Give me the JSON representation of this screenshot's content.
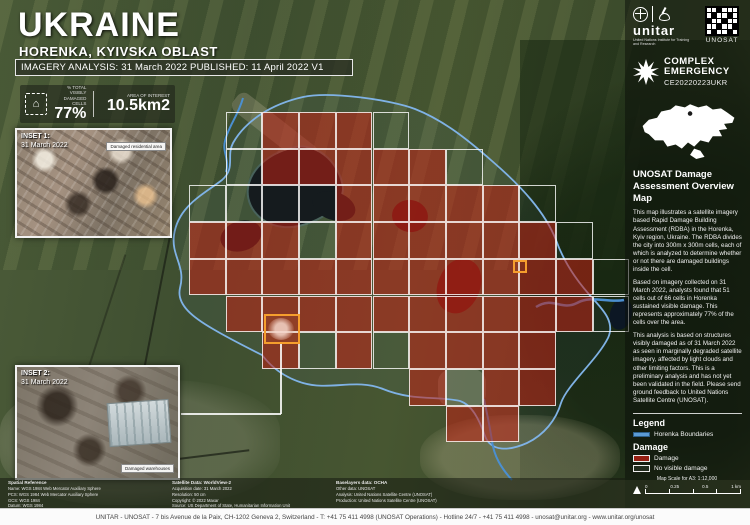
{
  "header": {
    "title": "UKRAINE",
    "subtitle": "HORENKA, KYIVSKA OBLAST",
    "banner": "IMAGERY ANALYSIS: 31 March 2022 PUBLISHED: 11 April 2022 V1"
  },
  "stats": {
    "damaged_icon": "damaged-building-icon",
    "damaged_glyph": "⌂",
    "damaged_label": "% TOTAL VISIBLY DAMAGED CELLS",
    "damaged_value": "77%",
    "area_label": "AREA OF INTEREST",
    "area_value": "10.5km2"
  },
  "insets": [
    {
      "name": "INSET 1:",
      "date": "31 March 2022",
      "callout": "Damaged residential area"
    },
    {
      "name": "INSET 2:",
      "date": "31 March 2022",
      "callout": "Damaged warehouses"
    }
  ],
  "sidebar": {
    "unitar_label": "unitar",
    "unitar_caption": "United Nations Institute for Training and Research",
    "unosat_label": "UNOSAT",
    "emergency_line1": "COMPLEX",
    "emergency_line2": "EMERGENCY",
    "emergency_code": "CE20220223UKR",
    "overview_title": "UNOSAT Damage Assessment Overview Map",
    "paragraphs": [
      "This map illustrates a satellite imagery based Rapid Damage Building Assessment (RDBA) in the Horenka, Kyiv region, Ukraine. The RDBA divides the city into 300m x 300m cells, each of which is analyzed to determine whether or not there are damaged buildings inside the cell.",
      "Based on imagery collected on 31 March 2022, analysts found that 51 cells out of 66 cells in Horenka sustained visible damage. This represents approximately 77% of the cells over the area.",
      "This analysis is based on structures visibly damaged as of 31 March 2022 as seen in marginally degraded satellite imagery, affected by light clouds and other limiting factors. This is a preliminary analysis and has not yet been validated in the field. Please send ground feedback to United Nations Satellite Centre (UNOSAT)."
    ],
    "legend": {
      "title": "Legend",
      "boundary_label": "Horenka Boundaries",
      "damage_group": "Damage",
      "damage_label": "Damage",
      "no_damage_label": "No visible damage",
      "damage_color": "rgba(193,33,20,0.75)",
      "boundary_color": "#5b9bd5"
    },
    "scale": {
      "caption": "Map Scale for A3: 1:12,000",
      "ticks": [
        "0",
        "0.25",
        "0.5",
        "1 km"
      ]
    }
  },
  "map_grid": {
    "origin_x": 189,
    "origin_y": 112,
    "cell_size": 36.7,
    "damage_fill": "rgba(193,33,20,0.55)",
    "rows": [
      ".ndddn......",
      ".ndddddn....",
      "nnnndddddn..",
      "dddnddddddn.",
      "dddddddddddn",
      ".ddddddddddn",
      "..dndndddd..",
      "......dndd..",
      ".......dd..."
    ]
  },
  "credits": {
    "columns": [
      [
        "Spatial Reference",
        "Name: WGS 1984 Web Mercator Auxiliary Sphere",
        "PCS: WGS 1984 Web Mercator Auxiliary Sphere",
        "GCS: WGS 1984",
        "Datum: WGS 1984",
        "Projection: Mercator Auxiliary Sphere"
      ],
      [
        "Satellite Data: WorldView-2",
        "Acquisition date: 31 March 2022",
        "Resolution: 50 cm",
        "Copyright: © 2022 Maxar",
        "Source: US Department of State, Humanitarian Information Unit",
        "Lab: NextView License"
      ],
      [
        "Baselayers data: OCHA",
        "Other data: UNOSAT",
        "Analysis: United Nations Satellite Centre (UNOSAT)",
        "Production: United Nations Satellite Centre (UNOSAT)"
      ]
    ]
  },
  "footer": "UNITAR - UNOSAT - 7 bis Avenue de la Paix, CH-1202 Geneva 2, Switzerland - T: +41 75 411 4998 (UNOSAT Operations) - Hotline 24/7 - +41 75 411 4998 - unosat@unitar.org - www.unitar.org/unosat"
}
